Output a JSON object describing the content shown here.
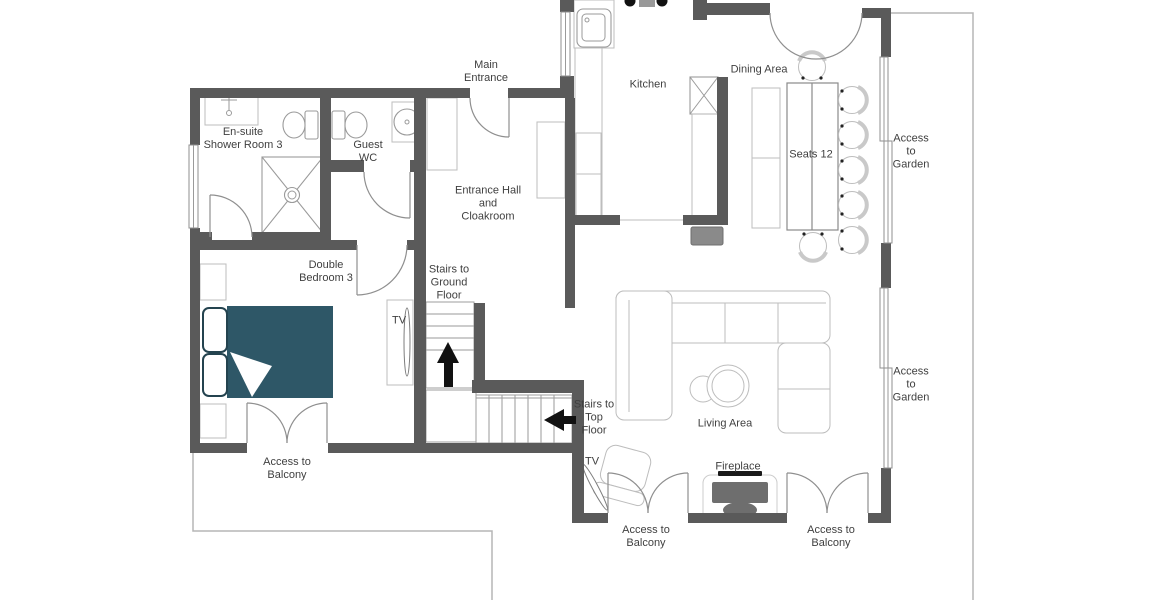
{
  "floor_plan": {
    "rooms": {
      "ensuite": "En-suite\nShower Room 3",
      "guest_wc": "Guest\nWC",
      "entrance_hall": "Entrance Hall\nand\nCloakroom",
      "kitchen": "Kitchen",
      "dining_area": "Dining Area",
      "double_bedroom": "Double\nBedroom 3",
      "living_area": "Living Area"
    },
    "annotations": {
      "main_entrance": "Main\nEntrance",
      "dining_seats": "Seats 12",
      "stairs_to_ground": "Stairs to\nGround\nFloor",
      "stairs_to_top": "Stairs to\nTop\nFloor",
      "tv_bedroom": "TV",
      "tv_living": "TV",
      "fireplace": "Fireplace",
      "access_garden_upper": "Access\nto\nGarden",
      "access_garden_lower": "Access\nto\nGarden",
      "access_balcony_bedroom": "Access to\nBalcony",
      "access_balcony_living_left": "Access to\nBalcony",
      "access_balcony_living_right": "Access to\nBalcony"
    },
    "colors": {
      "wall": "#5a5a5a",
      "bed_accent": "#2e5767",
      "fireplace_dark": "#6e6e6e",
      "media_unit_gray": "#8a8a8a",
      "arrow_black": "#111111"
    }
  }
}
